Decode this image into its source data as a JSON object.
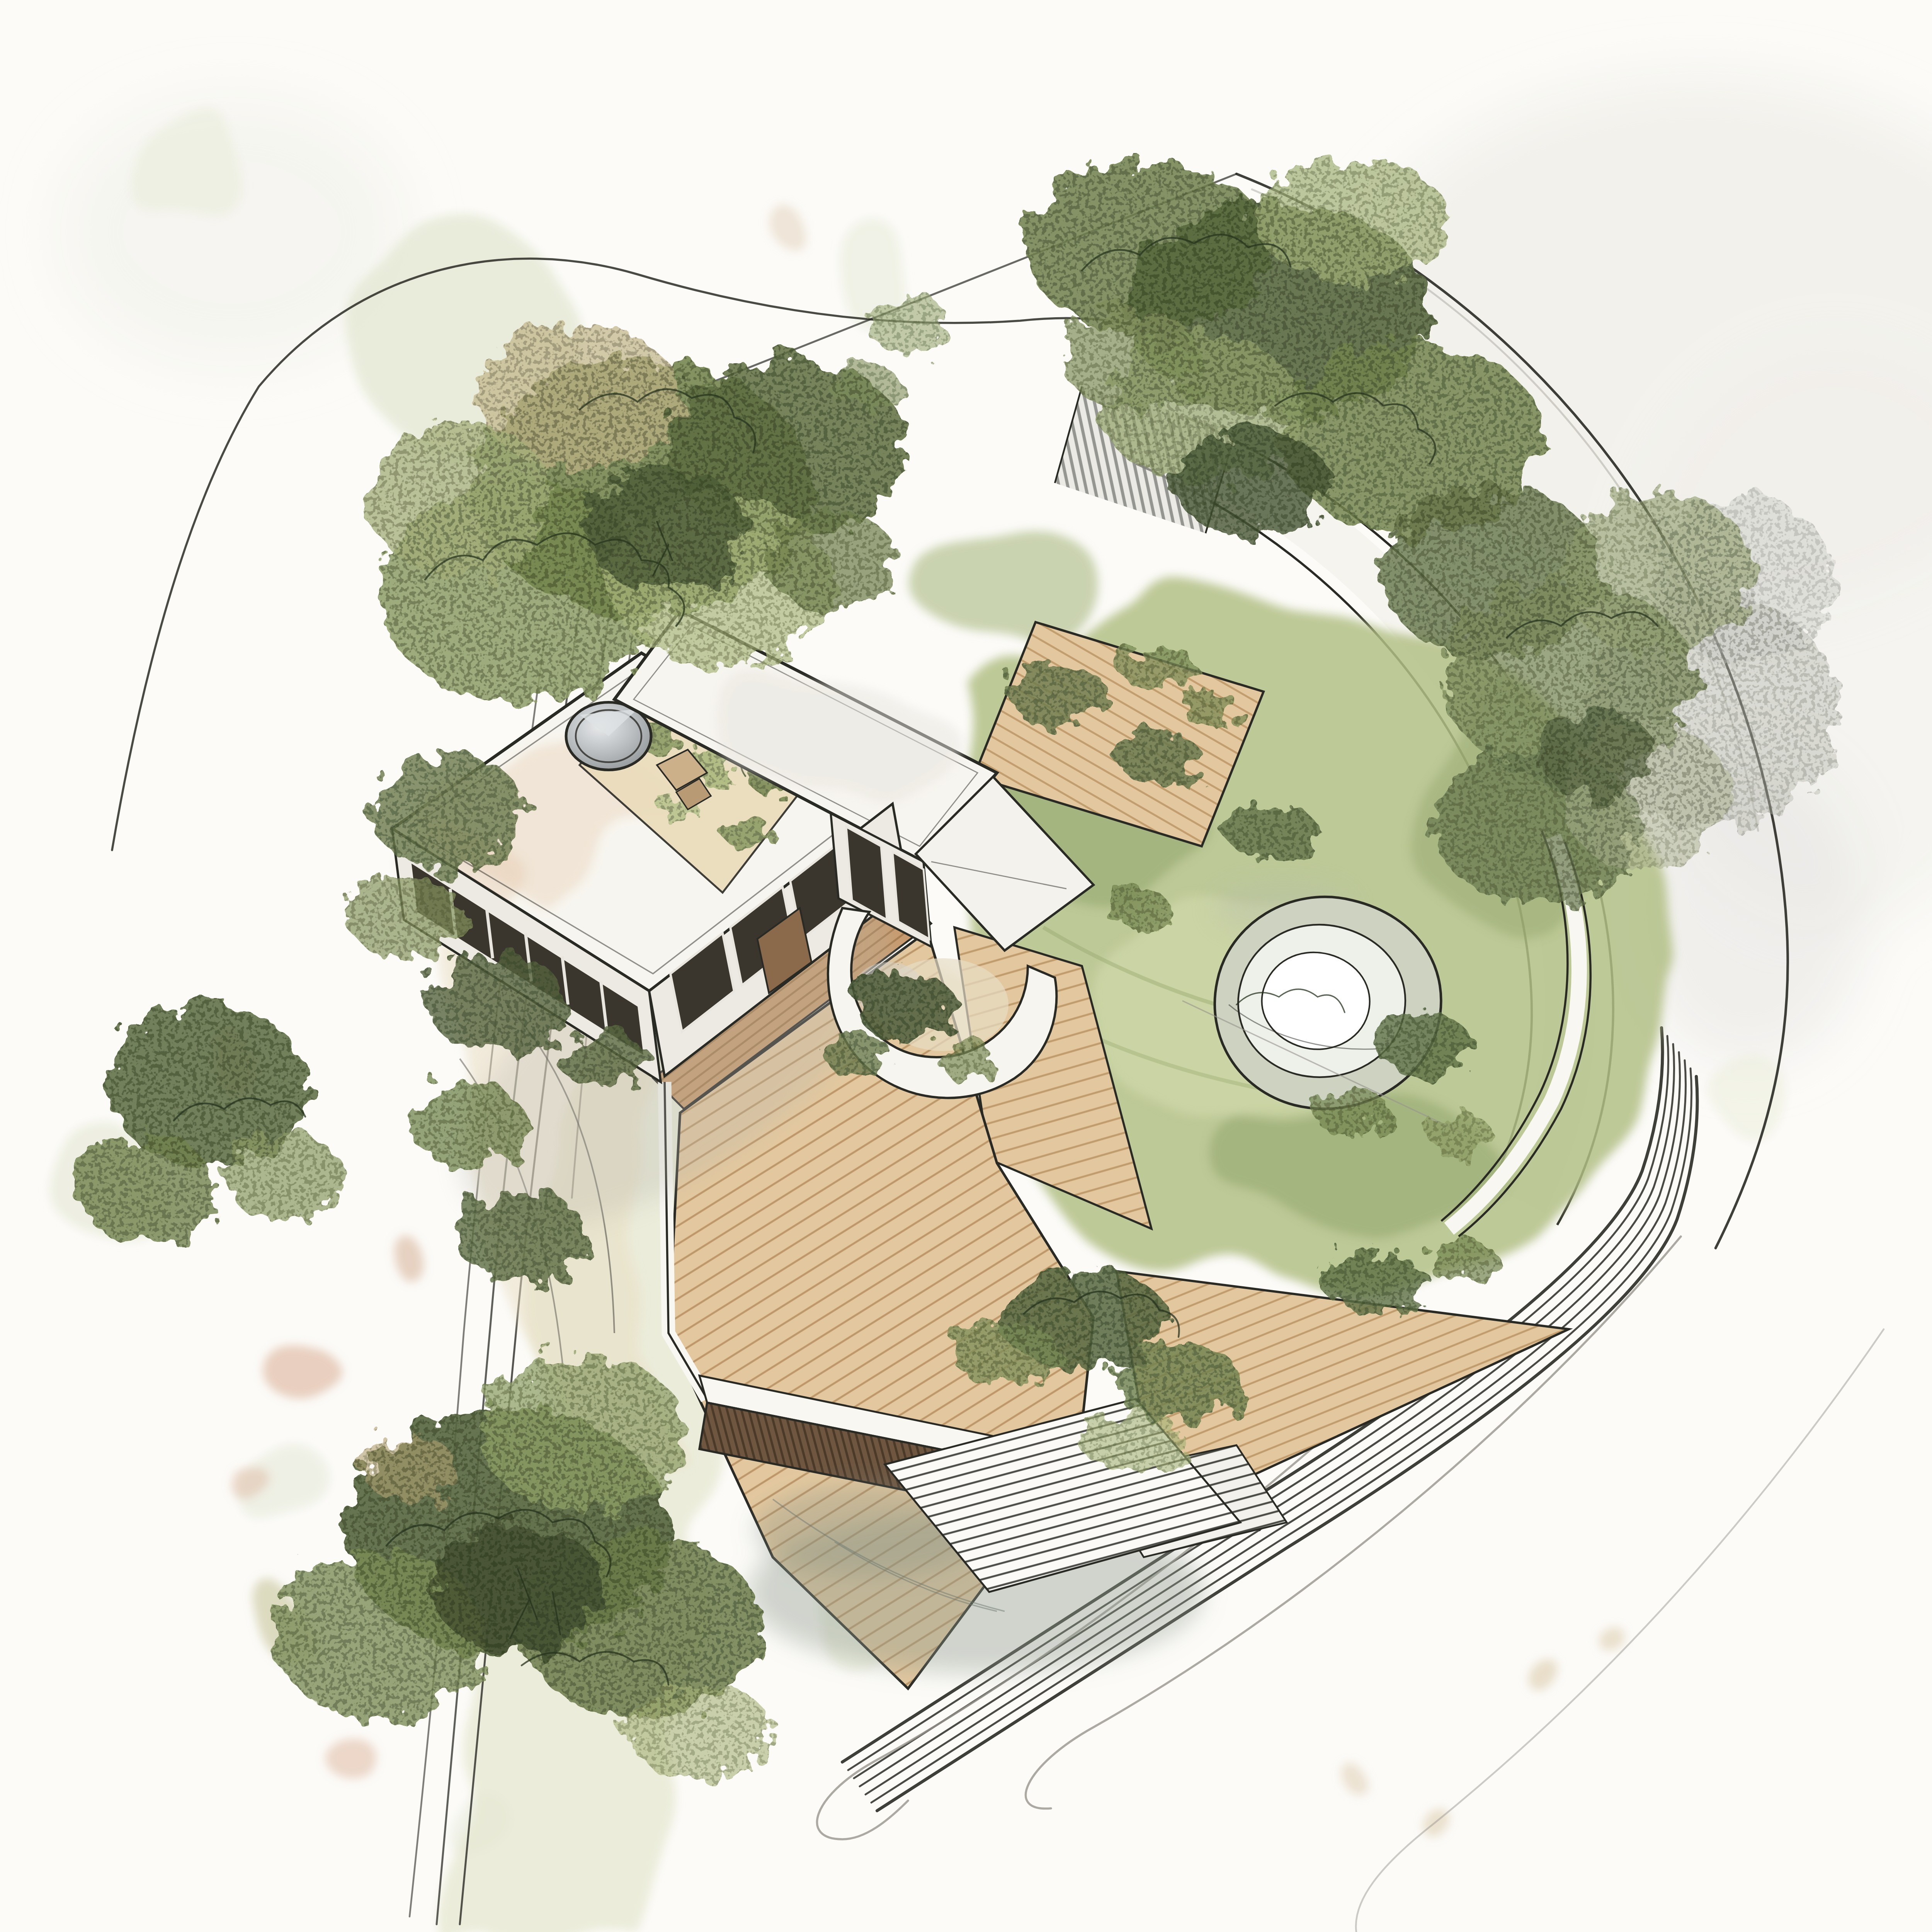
{
  "artwork": {
    "type": "architectural concept sketch",
    "view": "aerial axonometric bird's-eye view",
    "subject": "modern flat-roof house with roof garden, terraced timber deck, lawn, sunken pool and landscaped site",
    "medium": "ink line work with watercolor wash",
    "visible_text": "none"
  },
  "palette": {
    "paper": "#fcfbf8",
    "ink": "#2a2a25",
    "pencil": "#97958d",
    "foliage_dark": "#465534",
    "foliage_mid": "#74854f",
    "foliage_light": "#a9b77c",
    "foliage_sage": "#c2c89d",
    "foliage_tan": "#bfae82",
    "lawn": "#b2c086",
    "lawn_shade": "#8da167",
    "lawn_light": "#d4dcae",
    "deck_wood": "#e3c89f",
    "deck_wood_dark": "#c89a6c",
    "deck_plank_line": "#b08756",
    "timber_wall": "#6e5641",
    "roof_white": "#f7f5ef",
    "roof_wash": "#ecd9c2",
    "roof_garden": "#eadcba",
    "skylight_gray": "#a9adb0",
    "facade_light": "#eceae2",
    "glazing_dark": "#3a362e",
    "path_white": "#f5f3ed",
    "wash_sage": "#e4e6cd",
    "wash_gray": "#ecebe5",
    "wash_peach": "#ddb9a1",
    "shadow_green_gray": "#8f9a8d"
  },
  "scene": {
    "building": {
      "volumes": "two offset flat-roof volumes joined at an angle",
      "roof_features": [
        "circular skylight dome",
        "gravel roof garden with low shrubs",
        "small timber bench beside the dome"
      ],
      "facades": [
        "dark ribbon glazing band on west facade",
        "three sliding glass panels on south facade",
        "two tall windows on east volume",
        "timber entry door at the link"
      ]
    },
    "landscape": {
      "deck": "multi-level timber deck wrapping the house with an angular wedge pointing east",
      "planter": "curved white parapet planter with shrubs at the deck notch",
      "lawn": "irregular watercolor lawn with scattered shrubs",
      "water_feature": "sunken circular pool with concentric organic rims",
      "retaining": "dark timber slat retaining wall below the south deck edge",
      "trees": [
        "north cluster over the path",
        "large north-west cluster",
        "east cluster fading into grey wash",
        "west hedge row along lane",
        "dense south-west cluster"
      ]
    },
    "circulation": {
      "paths": [
        "white path sweeping from north steps around the east side",
        "graphite hatched steps on the north path",
        "small hatched steps below the deck",
        "wide hatched stair at the south",
        "kerbed multi-line road band curving at the south-east",
        "straight lane lines through the west hedge"
      ],
      "ground_marks": [
        "loose pencil sweep curves at the south-east",
        "pale sage watercolor blobs",
        "peach pigment spots on the paper"
      ]
    }
  }
}
